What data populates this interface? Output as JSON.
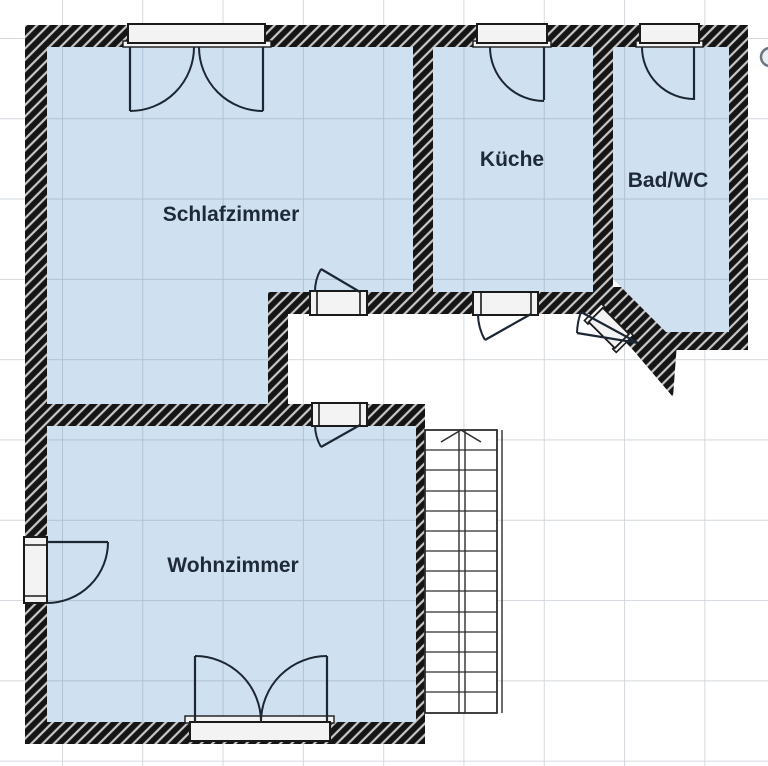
{
  "plan": {
    "type": "floor-plan",
    "rooms": [
      {
        "id": "schlafzimmer",
        "label": "Schlafzimmer"
      },
      {
        "id": "kueche",
        "label": "Küche"
      },
      {
        "id": "badwc",
        "label": "Bad/WC"
      },
      {
        "id": "wohnzimmer",
        "label": "Wohnzimmer"
      }
    ],
    "stairs": {
      "steps": 14,
      "direction": "up"
    },
    "doors": [
      "schlafzimmer-door",
      "kueche-door",
      "wohnzimmer-door",
      "badwc-diagonal-door",
      "balcony-door",
      "french-double-door"
    ],
    "windows": [
      "schlafzimmer-double-window",
      "kueche-window",
      "badwc-window"
    ]
  },
  "colors": {
    "background": "#ffffff",
    "room_fill": "#cfe0f0",
    "wall_fill": "#151515",
    "wall_hatch_stripe": "#c8c8c8",
    "line": "#1c2733",
    "frame_fill": "#f3f3f3",
    "grid_line": "#64788c",
    "label_text": "#1e2a38"
  }
}
